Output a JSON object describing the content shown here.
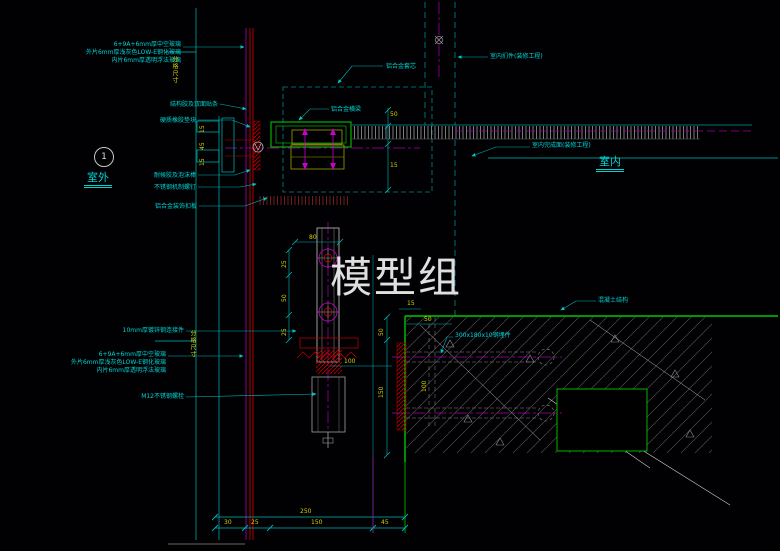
{
  "drawing": {
    "watermark": "模型组",
    "detail_marker": {
      "number": "1",
      "zone_exterior": "室外",
      "zone_interior": "室内"
    },
    "callouts": {
      "glass_spec": [
        "6+9A+6mm厚中空玻璃",
        "外片6mm厚浅灰色LOW-E钢化玻璃",
        "内片6mm厚透明浮法玻璃"
      ],
      "structural_sealant": "结构胶及双面贴条",
      "rubber_block": "硬质橡胶垫块",
      "weather_sealant": "耐候胶及泡沫棒",
      "ss_screw": "不锈钢机制螺钉",
      "alu_trim": "铝合金装饰扣板",
      "alu_core": "铝合金套芯",
      "alu_transom": "铝合金横梁",
      "interior_panel": "室内扪件(装修工程)",
      "interior_finish": "室内完成面(装修工程)",
      "concrete": "混凝土结构",
      "embed_plate": "300x180x10钢埋件",
      "steel_connector": "10mm厚镀锌钢连接件",
      "anchor_bolt": "M12不锈钢螺栓",
      "grid_dim": "分格尺寸"
    },
    "dimensions": {
      "bracket_width": "80",
      "bracket_left_top": "25",
      "bracket_left_mid": "50",
      "bracket_left_bot": "25",
      "bracket_bottom": "100",
      "gap": "15",
      "edge": "50",
      "embed_height": "100",
      "slab_upper": "50",
      "slab_lower": "150",
      "transom_upper": "50",
      "transom_lower": "15",
      "mullion_top": "15",
      "mullion_mid": "45",
      "mullion_bot": "15",
      "bottom_total": "250",
      "bottom_seg1": "30",
      "bottom_seg2": "25",
      "bottom_seg3": "150",
      "bottom_seg4": "45"
    },
    "colors": {
      "background": "#010103",
      "line_cyan": "#00c8c8",
      "line_red": "#dc0000",
      "line_magenta": "#c000c0",
      "line_green": "#00c800",
      "dim_yellow": "#d2d200",
      "hatch_grey": "#5a5a5a",
      "watermark_grey": "#ebebeb"
    }
  }
}
